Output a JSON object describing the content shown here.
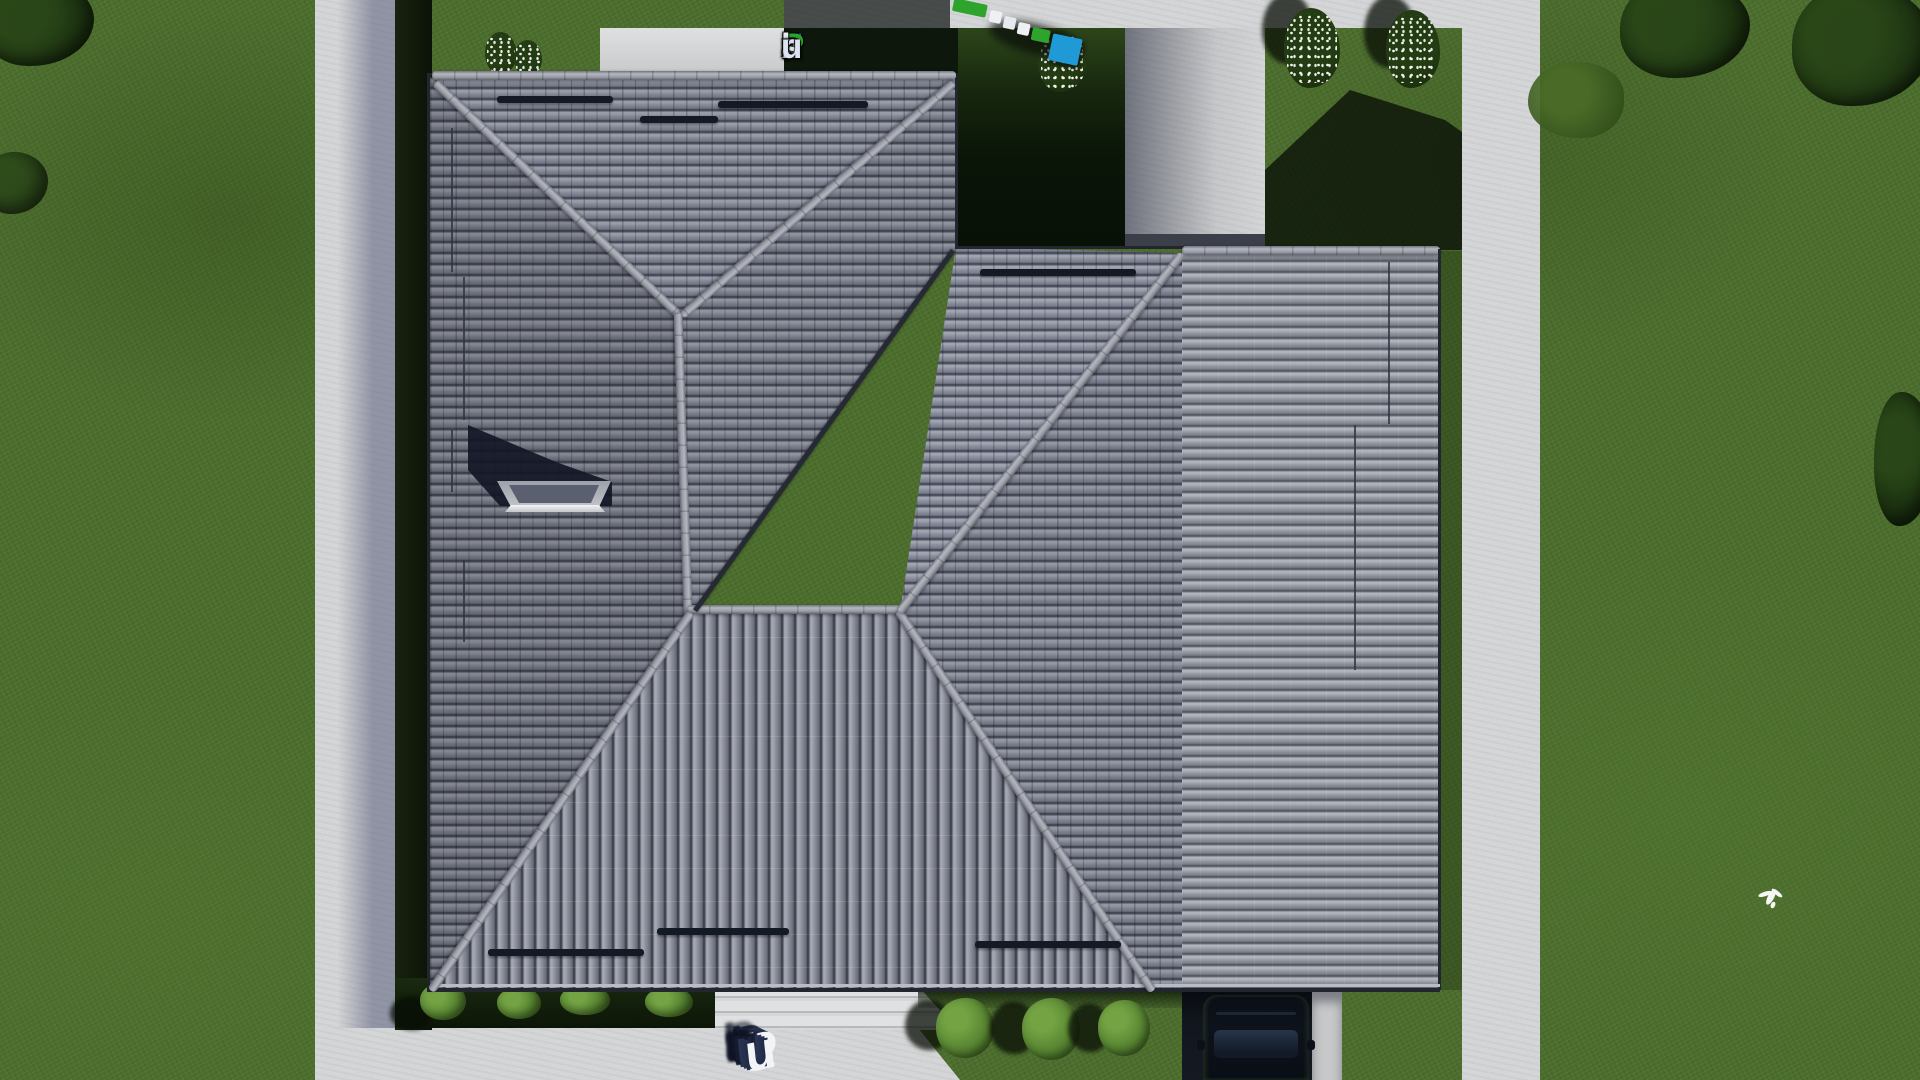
{
  "scene": {
    "description": "Top-down aerial 3D render of a hip-roof house plan with lawn, concrete paths, driveway and car",
    "objects": [
      "hip-roof-house",
      "garage-roof-wing",
      "skylight",
      "snow-guards",
      "lawn",
      "concrete-paths",
      "entrance-steps",
      "driveway",
      "parked-car",
      "flower-bushes",
      "green-bushes",
      "trees",
      "flying-bird"
    ]
  },
  "watermark_top": {
    "text": "FixPlans.ru",
    "letters": [
      {
        "ch": "F",
        "color": "#2f64c8"
      },
      {
        "ch": "i",
        "color": "#2fa42c"
      },
      {
        "ch": "x",
        "color": "#e9ebf2"
      },
      {
        "ch": "P",
        "color": "#2fa42c"
      },
      {
        "ch": "l",
        "color": "#e9ebf2"
      },
      {
        "ch": "a",
        "color": "#e9ebf2"
      },
      {
        "ch": "n",
        "color": "#e9ebf2"
      },
      {
        "ch": "s",
        "color": "#e9ebf2"
      },
      {
        "ch": ".",
        "color": "#2b84d6"
      },
      {
        "ch": "r",
        "color": "#dde3f0"
      },
      {
        "ch": "u",
        "color": "#dde3f0"
      }
    ]
  },
  "watermark_ground": {
    "text": "Plans.ru",
    "letters": [
      {
        "ch": "P",
        "color": "#f2f4f8"
      },
      {
        "ch": "l",
        "color": "#f2f4f8"
      },
      {
        "ch": "a",
        "color": "#f2f4f8"
      },
      {
        "ch": "n",
        "color": "#f2f4f8"
      },
      {
        "ch": "s",
        "color": "#f2f4f8"
      },
      {
        "ch": ".",
        "color": "#2f9fe0"
      },
      {
        "ch": "r",
        "color": "#f2f4f8"
      },
      {
        "ch": "u",
        "color": "#f2f4f8"
      }
    ]
  },
  "colors": {
    "grass": "#4c6e2d",
    "grass_shadow": "#0c1607",
    "concrete": "#d4d5d6",
    "roof_tile": "#83869a",
    "roof_ridge": "#aaadb4",
    "roof_south_plane": "#8a8e9a",
    "garage_tile": "#9599a2",
    "driveway": "#12161e",
    "car": "#0d121b",
    "foliage_dark": "#1b3010",
    "bush_light": "#558230",
    "flowers": "#ffffff",
    "brand_blue": "#2f64c8",
    "brand_green": "#2fa42c"
  }
}
